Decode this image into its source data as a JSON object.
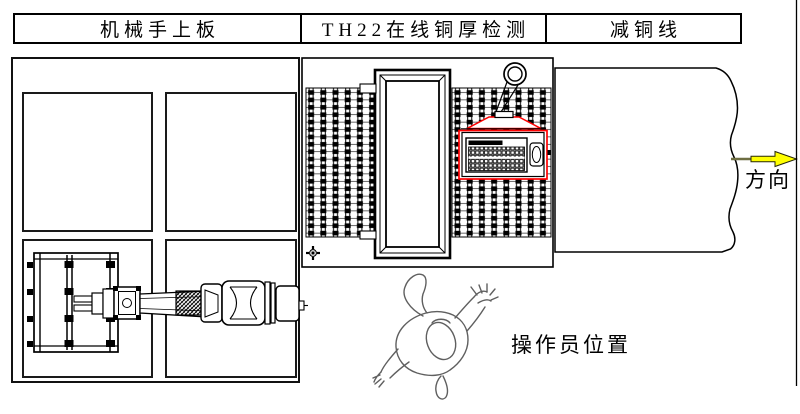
{
  "header": {
    "cells": [
      {
        "label": "机械手上板"
      },
      {
        "label": "TH22在线铜厚检测"
      },
      {
        "label": "减铜线"
      }
    ]
  },
  "annotations": {
    "operator_label": "操作员位置",
    "direction_label": "方向"
  },
  "icons": {
    "direction_arrow": "yellow-right-block-arrow",
    "hoist_ring": "double-circle-ring",
    "datum_marker": "crosshair-circle"
  },
  "colors": {
    "line": "#000000",
    "highlight_red": "#ff0000",
    "arrow_yellow": "#ffff00",
    "figure_gray": "#5f5f5f",
    "background": "#ffffff"
  }
}
